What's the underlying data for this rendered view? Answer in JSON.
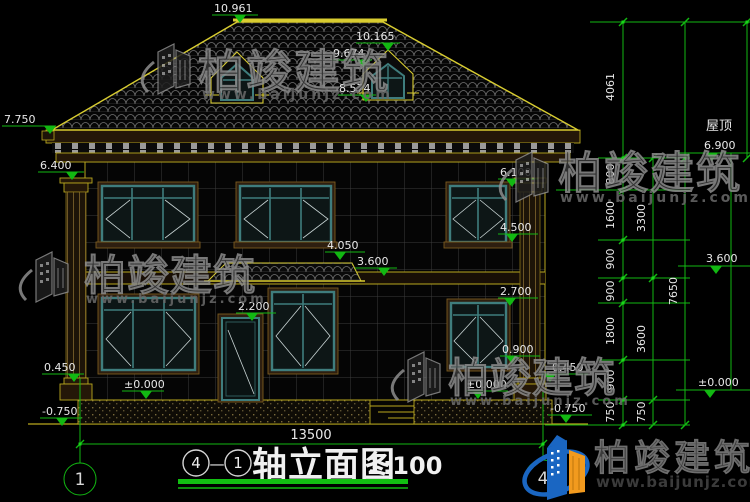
{
  "drawing": {
    "title": {
      "axis_start_bubble": "4",
      "separator": "—",
      "axis_end_bubble": "1",
      "name": "轴立面图",
      "scale": "1:100"
    },
    "axis_bubbles": {
      "left": "1",
      "right": "4"
    },
    "roof_section_label": "屋顶",
    "levels": {
      "ridge": "10.961",
      "dormer_peak": "10.165",
      "dormer_window_top": "9.674",
      "dormer_window_bottom": "8.574",
      "eave": "7.750",
      "roof": "6.900",
      "wall_top": "6.400",
      "floor2_window_top": "6.100",
      "floor2_window_bottom": "4.500",
      "canopy": "4.050",
      "floor2": "3.600",
      "floor2_right": "3.600",
      "floor1_window_top": "2.700",
      "door_top": "2.200",
      "floor1_window_bottom": "0.900",
      "plinth_left": "0.450",
      "plinth_right": "0.450",
      "zero_left": "±0.000",
      "zero_center": "±0.000",
      "zero_right": "±0.000",
      "ground_left": "-0.750",
      "ground_right": "-0.750"
    },
    "dimensions": {
      "total_width": "13500",
      "chain_inner": [
        "4061",
        "800",
        "1600",
        "900",
        "900",
        "1800",
        "900",
        "750"
      ],
      "chain_middle": [
        "3300",
        "3600",
        "750"
      ],
      "chain_outer": [
        "7650"
      ]
    }
  },
  "watermark": {
    "name": "柏竣建筑",
    "website": "www.baijunjz.com"
  },
  "brand": {
    "name": "柏竣建筑",
    "website": "www.baijunjz.com"
  },
  "colors": {
    "dimension_green": "#12b812",
    "cad_yellow": "#b9a81e",
    "roof_edge_yellow": "#d8cc30",
    "window_teal": "#3f7d7d",
    "brand_blue": "#1a66c2",
    "brand_orange": "#f29a1e"
  }
}
